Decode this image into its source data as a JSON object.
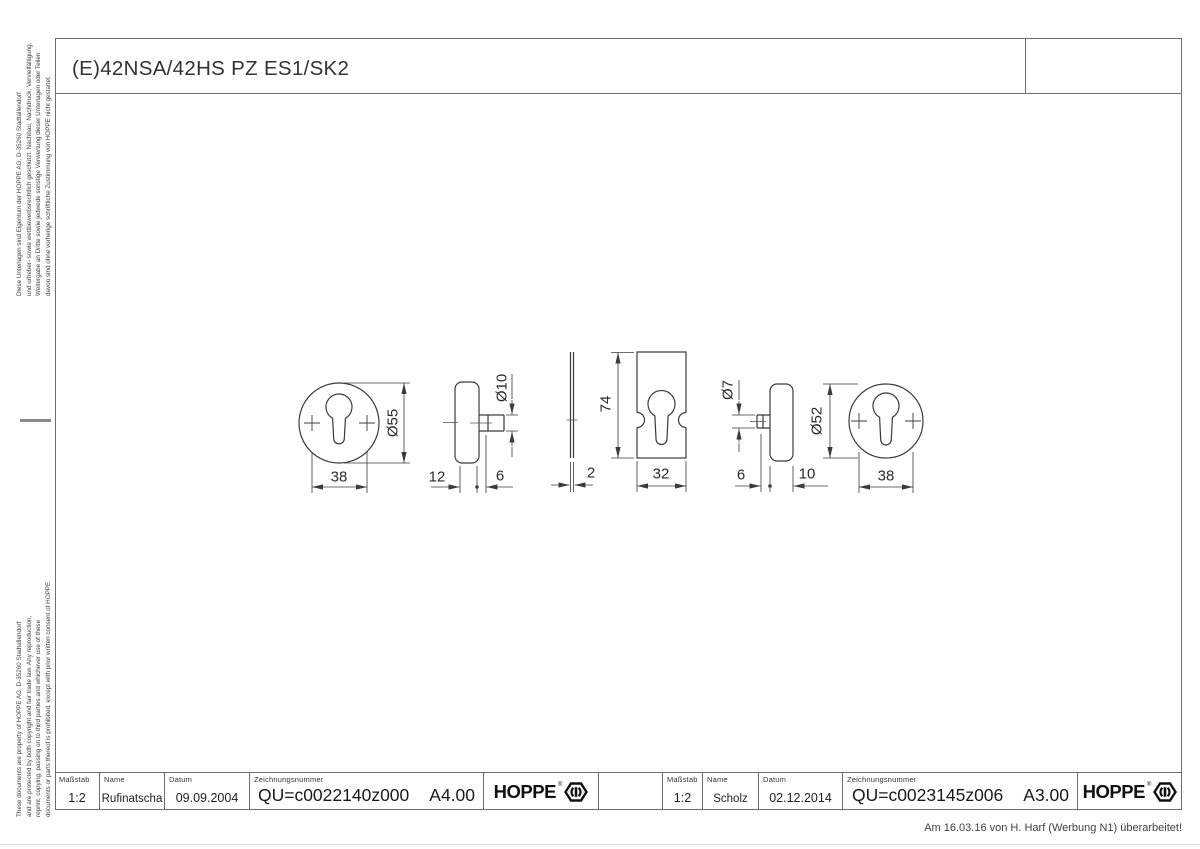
{
  "page": {
    "title": "(E)42NSA/42HS PZ ES1/SK2",
    "revision_note": "Am 16.03.16 von H. Harf (Werbung N1) überarbeitet!"
  },
  "colors": {
    "line": "#3b3b3b",
    "frame": "#6e6e6e",
    "text": "#222222"
  },
  "icons": {
    "brand": "hoppe-hexagon-icon"
  },
  "side_notes": {
    "german_lines": [
      "Diese Unterlagen sind Eigentum der HOPPE AG, D-35260 Stadtallendorf",
      "und urheber- sowie wettbewerbsrechtlich geschützt. Nachbau, Nachdruck, Vervielfältigung,",
      "Weitergabe an Dritte sowie jedwede sonstige Verwertung dieser Unterlagen oder Teilen",
      "davon sind ohne vorherige schriftliche Zustimmung von HOPPE nicht gestattet."
    ],
    "english_lines": [
      "These documents are property of HOPPE AG, D-35260 Stadtallendorf",
      "and are protected by both copyright and fair trade law. Any reproduction,",
      "reprint, copying, passing on to third parties and whichever use of these",
      "documents or parts thereof is prohibited, except with prior written consent of HOPPE."
    ]
  },
  "title_blocks": [
    {
      "scale_label": "Maßstab",
      "scale": "1:2",
      "name_label": "Name",
      "name": "Rufinatscha",
      "date_label": "Datum",
      "date": "09.09.2004",
      "drawing_no_label": "Zeichnungsnummer",
      "drawing_no": "QU=c0022140z000",
      "revision": "A4.00",
      "brand": "HOPPE"
    },
    {
      "scale_label": "Maßstab",
      "scale": "1:2",
      "name_label": "Name",
      "name": "Scholz",
      "date_label": "Datum",
      "date": "02.12.2014",
      "drawing_no_label": "Zeichnungsnummer",
      "drawing_no": "QU=c0023145z006",
      "revision": "A3.00",
      "brand": "HOPPE"
    }
  ],
  "dimensions": {
    "rosette_left_width": "38",
    "rosette_left_dia": "Ø55",
    "rosette_left_thickness": "12",
    "pin_left_dia": "Ø10",
    "pin_left_len": "6",
    "plate_thickness": "2",
    "plate_height": "74",
    "plate_width": "32",
    "pin_right_dia": "Ø7",
    "pin_right_len": "6",
    "rosette_right_thickness": "10",
    "rosette_right_dia": "Ø52",
    "rosette_right_width": "38"
  }
}
